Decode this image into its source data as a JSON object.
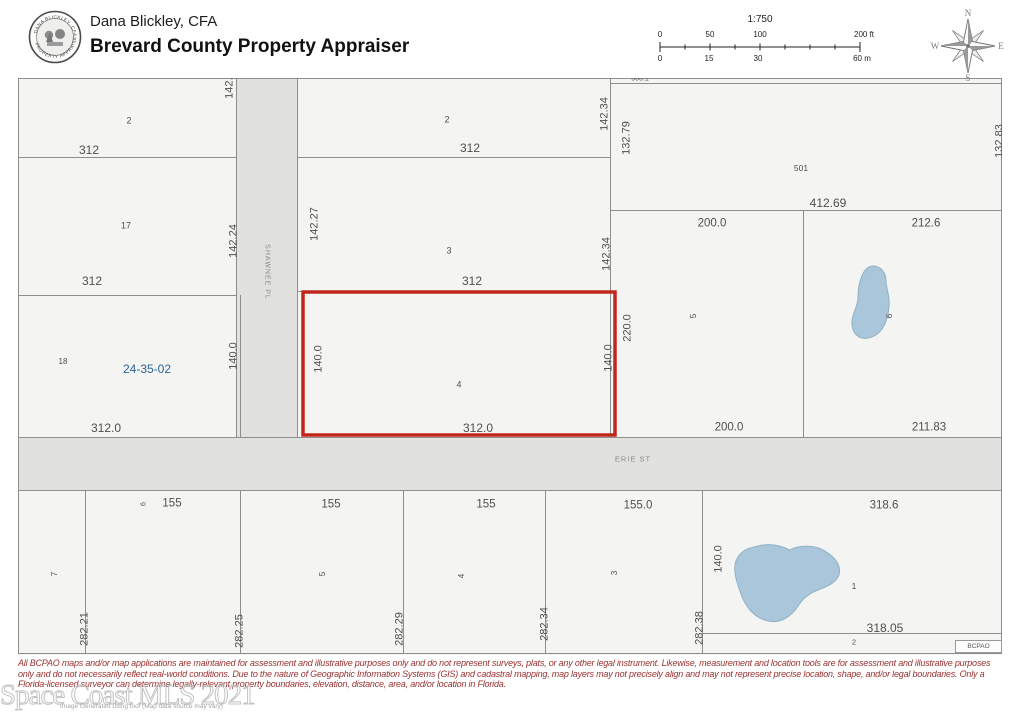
{
  "header": {
    "name": "Dana Blickley, CFA",
    "title": "Brevard County Property Appraiser",
    "seal_top_text": "DANA BLICKLEY, CFA",
    "seal_bottom_text": "PROPERTY APPRAISER"
  },
  "scalebar": {
    "ratio": "1:750",
    "feet": [
      "0",
      "50",
      "100",
      "200 ft"
    ],
    "meters": [
      "0",
      "15",
      "30",
      "60 m"
    ]
  },
  "compass": {
    "n": "N",
    "s": "S",
    "e": "E",
    "w": "W"
  },
  "map": {
    "parcel_id": "24-35-02",
    "subject_lot": "4",
    "streets": [
      "SHAWNEE PL",
      "ERIE ST"
    ],
    "bcpao": "BCPAO",
    "labels": [
      {
        "t": "2",
        "x": 111,
        "y": 43,
        "s": 9,
        "k": "lot-number-label"
      },
      {
        "t": "312",
        "x": 71,
        "y": 72,
        "s": 12
      },
      {
        "t": "142.24",
        "x": 212,
        "y": 4,
        "r": -90,
        "s": 11
      },
      {
        "t": "17",
        "x": 108,
        "y": 148,
        "s": 9,
        "k": "lot-number-label"
      },
      {
        "t": "142.24",
        "x": 216,
        "y": 163,
        "r": -90,
        "s": 11
      },
      {
        "t": "312",
        "x": 74,
        "y": 203,
        "s": 12
      },
      {
        "t": "18",
        "x": 45,
        "y": 284,
        "s": 8,
        "k": "lot-number-label"
      },
      {
        "t": "24-35-02",
        "x": 129,
        "y": 291,
        "s": 12,
        "c": "blue",
        "k": "parcel-id-label"
      },
      {
        "t": "140.0",
        "x": 216,
        "y": 278,
        "r": -90,
        "s": 11
      },
      {
        "t": "312.0",
        "x": 88,
        "y": 350,
        "s": 12
      },
      {
        "t": "SHAWNEE PL",
        "x": 249,
        "y": 194,
        "r": 90,
        "s": 7,
        "c": "street",
        "ls": 1,
        "k": "street-name-label"
      },
      {
        "t": "ERIE ST",
        "x": 615,
        "y": 381,
        "s": 7.5,
        "c": "street",
        "ls": 1,
        "k": "street-name-label"
      },
      {
        "t": "2",
        "x": 429,
        "y": 42,
        "s": 9,
        "k": "lot-number-label"
      },
      {
        "t": "312",
        "x": 452,
        "y": 70,
        "s": 12
      },
      {
        "t": "142.34",
        "x": 587,
        "y": 36,
        "r": -90,
        "s": 11
      },
      {
        "t": "142.27",
        "x": 297,
        "y": 146,
        "r": -90,
        "s": 11
      },
      {
        "t": "3",
        "x": 431,
        "y": 173,
        "s": 9,
        "k": "lot-number-label"
      },
      {
        "t": "312",
        "x": 454,
        "y": 203,
        "s": 12
      },
      {
        "t": "142.34",
        "x": 589,
        "y": 176,
        "r": -90,
        "s": 11
      },
      {
        "t": "4",
        "x": 441,
        "y": 307,
        "s": 9,
        "k": "lot-number-label"
      },
      {
        "t": "140.0",
        "x": 301,
        "y": 281,
        "r": -90,
        "s": 11
      },
      {
        "t": "140.0",
        "x": 591,
        "y": 280,
        "r": -90,
        "s": 11
      },
      {
        "t": "312.0",
        "x": 460,
        "y": 350,
        "s": 12
      },
      {
        "t": "500.1",
        "x": 622,
        "y": 1,
        "s": 7
      },
      {
        "t": "501",
        "x": 783,
        "y": 90,
        "s": 8.5,
        "k": "lot-number-label"
      },
      {
        "t": "132.79",
        "x": 609,
        "y": 60,
        "r": -90,
        "s": 11
      },
      {
        "t": "412.69",
        "x": 810,
        "y": 125,
        "s": 12
      },
      {
        "t": "132.83",
        "x": 982,
        "y": 63,
        "r": -90,
        "s": 11
      },
      {
        "t": "200.0",
        "x": 694,
        "y": 146,
        "s": 11.5
      },
      {
        "t": "220.0",
        "x": 610,
        "y": 250,
        "r": -90,
        "s": 11
      },
      {
        "t": "5",
        "x": 675,
        "y": 238,
        "r": -90,
        "s": 8.5,
        "k": "lot-number-label"
      },
      {
        "t": "200.0",
        "x": 711,
        "y": 350,
        "s": 11.5
      },
      {
        "t": "212.6",
        "x": 908,
        "y": 146,
        "s": 11.5
      },
      {
        "t": "6",
        "x": 871,
        "y": 238,
        "r": -90,
        "s": 8.5,
        "k": "lot-number-label"
      },
      {
        "t": "211.83",
        "x": 911,
        "y": 350,
        "s": 11.5
      },
      {
        "t": "6",
        "x": 126,
        "y": 426,
        "r": -90,
        "s": 7,
        "k": "lot-number-label"
      },
      {
        "t": "155",
        "x": 154,
        "y": 426,
        "s": 11.5
      },
      {
        "t": "155",
        "x": 313,
        "y": 427,
        "s": 11.5
      },
      {
        "t": "155",
        "x": 468,
        "y": 427,
        "s": 11.5
      },
      {
        "t": "155.0",
        "x": 620,
        "y": 428,
        "s": 11.5
      },
      {
        "t": "318.6",
        "x": 866,
        "y": 428,
        "s": 11.5
      },
      {
        "t": "7",
        "x": 37,
        "y": 496,
        "r": -90,
        "s": 8,
        "k": "lot-number-label"
      },
      {
        "t": "5",
        "x": 305,
        "y": 496,
        "r": -90,
        "s": 8,
        "k": "lot-number-label"
      },
      {
        "t": "4",
        "x": 444,
        "y": 498,
        "r": -90,
        "s": 8,
        "k": "lot-number-label"
      },
      {
        "t": "3",
        "x": 597,
        "y": 495,
        "r": -90,
        "s": 8,
        "k": "lot-number-label"
      },
      {
        "t": "282.21",
        "x": 67,
        "y": 551,
        "r": -90,
        "s": 11
      },
      {
        "t": "282.25",
        "x": 222,
        "y": 553,
        "r": -90,
        "s": 11
      },
      {
        "t": "282.29",
        "x": 382,
        "y": 551,
        "r": -90,
        "s": 11
      },
      {
        "t": "282.34",
        "x": 527,
        "y": 546,
        "r": -90,
        "s": 11
      },
      {
        "t": "282.38",
        "x": 682,
        "y": 550,
        "r": -90,
        "s": 11
      },
      {
        "t": "140.0",
        "x": 701,
        "y": 481,
        "r": -90,
        "s": 11
      },
      {
        "t": "1",
        "x": 836,
        "y": 508,
        "s": 8.5,
        "k": "lot-number-label"
      },
      {
        "t": "318.05",
        "x": 867,
        "y": 550,
        "s": 12
      },
      {
        "t": "2",
        "x": 836,
        "y": 564,
        "s": 7.5,
        "k": "lot-number-label"
      }
    ]
  },
  "watermark": {
    "text": "Space Coast MLS 2021",
    "subtext": "Image Generated using tool (Map data source may vary)"
  },
  "disclaimer": {
    "lines": [
      "All BCPAO maps and/or map applications are maintained for assessment and illustrative purposes only and do not represent surveys, plats, or any other legal instrument. Likewise, measurement and location tools are for assessment and illustrative purposes",
      "only and do not necessarily reflect real-world conditions. Due to the nature of Geographic Information Systems (GIS) and cadastral mapping, map layers may not precisely align and may not represent precise location, shape, and/or legal boundaries. Only a",
      "Florida-licensed surveyor can determine legally-relevant property boundaries, elevation, distance, area, and/or location in Florida."
    ]
  },
  "colors": {
    "subject_outline_red": "#c1261b",
    "water_blue": "#a9c6da",
    "street_fill": "#e1e1df",
    "parcel_fill": "#f4f4f2",
    "parcel_line": "#8e8e8c",
    "parcel_id_blue": "#2d6597",
    "disclaimer_red": "#9b3030"
  }
}
